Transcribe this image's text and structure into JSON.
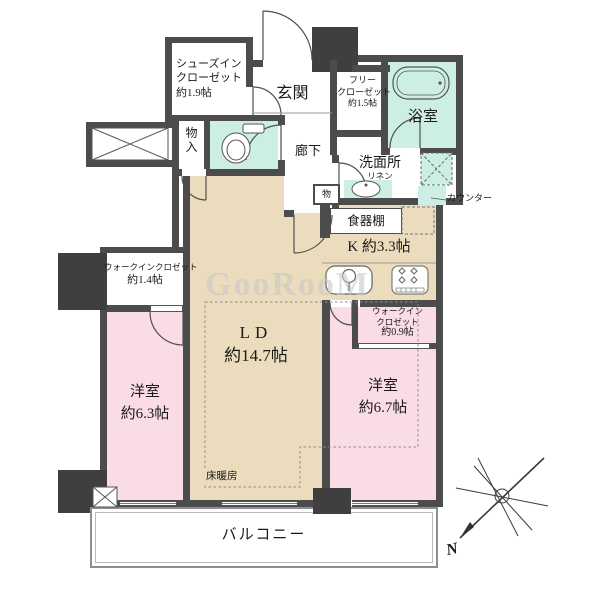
{
  "plan": {
    "type": "floor-plan",
    "rooms": {
      "shoes_in_closet": {
        "lines": [
          "シューズイン",
          "クローゼット",
          "約1.9帖"
        ]
      },
      "entrance": {
        "label": "玄関"
      },
      "free_closet": {
        "lines": [
          "フリー",
          "クローゼット",
          "約1.5帖"
        ]
      },
      "bathroom": {
        "label": "浴室"
      },
      "washroom": {
        "label": "洗面所",
        "linen_label": "リネン",
        "counter_label": "カウンター"
      },
      "hall_storage": {
        "chars": [
          "物",
          "入"
        ]
      },
      "hallway": {
        "label": "廊下"
      },
      "small_storage": {
        "label": "物"
      },
      "kitchen": {
        "label": "K 約3.3帖",
        "cupboard_label": "食器棚"
      },
      "living_dining": {
        "name_label": "LD",
        "size_label": "約14.7帖",
        "floor_heating_label": "床暖房"
      },
      "wic_left": {
        "lines": [
          "ウォークインクロゼット",
          "約1.4帖"
        ]
      },
      "wic_right": {
        "lines": [
          "ウォークイン",
          "クロゼット",
          "約0.9帖"
        ]
      },
      "bedroom_left": {
        "lines": [
          "洋室",
          "約6.3帖"
        ]
      },
      "bedroom_right": {
        "lines": [
          "洋室",
          "約6.7帖"
        ]
      },
      "balcony": {
        "label": "バルコニー"
      }
    },
    "compass": {
      "north_label": "N"
    },
    "watermark": {
      "text": "GooRooM"
    },
    "colors": {
      "wall": "#4c4c4c",
      "pillar": "#3f3f3f",
      "floor_ldk": "#eadcbc",
      "floor_bedroom": "#fadde4",
      "floor_wet": "#cdeee4"
    }
  }
}
